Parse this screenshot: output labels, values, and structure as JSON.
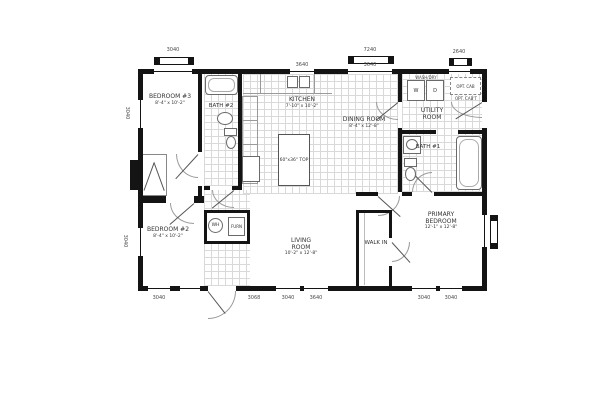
{
  "rooms": {
    "bedroom3": {
      "name": "BEDROOM #3",
      "dims": "8'-4\" x 10'-2\""
    },
    "bath2": {
      "name": "BATH #2"
    },
    "kitchen": {
      "name": "KITCHEN",
      "dims": "7'-10\" x 10'-2\""
    },
    "dining": {
      "name": "DINING ROOM",
      "dims": "8'-4\" x 12'-8\""
    },
    "utility": {
      "name": "UTILITY ROOM"
    },
    "bath1": {
      "name": "BATH #1"
    },
    "bedroom2": {
      "name": "BEDROOM #2",
      "dims": "8'-4\" x 10'-2\""
    },
    "living": {
      "name": "LIVING ROOM",
      "dims": "10'-2\" x 12'-8\""
    },
    "walkin": {
      "name": "WALK IN"
    },
    "primary": {
      "name": "PRIMARY BEDROOM",
      "dims": "12'-1\" x 12'-8\""
    }
  },
  "equipment": {
    "washer": "W",
    "dryer": "D",
    "laundry_caption": "WASH/DRY",
    "opt_cab": "OPT. CAB",
    "opt_cabt": "OPT. CAB'T",
    "water_heater": "WH",
    "furnace": "FURN",
    "island": "60\"x36\" TOP"
  },
  "callouts": {
    "top": [
      "3040",
      "3640",
      "7240",
      "3640",
      "2640"
    ],
    "bottom": [
      "3040",
      "3068",
      "3040",
      "3640",
      "3040",
      "3040"
    ],
    "left": [
      "3040",
      "3040"
    ]
  }
}
